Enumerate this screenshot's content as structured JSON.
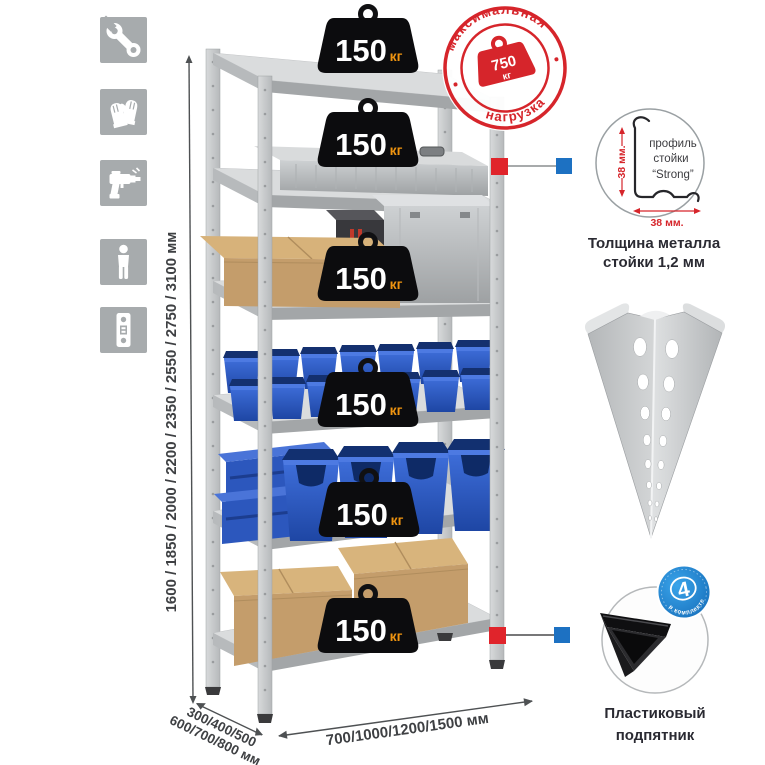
{
  "canvas": {
    "width": 765,
    "height": 765,
    "background": "#ffffff"
  },
  "sidebar_icons": [
    "wrench-icon",
    "gloves-icon",
    "drill-icon",
    "person-icon",
    "perforated-post-icon"
  ],
  "rack": {
    "shelf_count": 6,
    "shelf_load": {
      "value": "150",
      "unit": "кг"
    }
  },
  "stamp": {
    "arc_top": "максимальная",
    "arc_bottom": "нагрузка",
    "weight_value": "750",
    "weight_unit": "кг"
  },
  "dimensions": {
    "height": "1600 / 1850 / 2000 / 2200 / 2350 / 2550 / 2750 / 3100 мм",
    "depth_line1": "300/400/500",
    "depth_line2": "600/700/800 мм",
    "width": "700/1000/1200/1500 мм"
  },
  "profile_detail": {
    "label_line1": "профиль",
    "label_line2": "стойки",
    "label_line3": "“Strong”",
    "dim_vertical": "38 мм.",
    "dim_horizontal": "38 мм.",
    "caption_line1": "Толщина металла",
    "caption_line2": "стойки 1,2 мм"
  },
  "foot_detail": {
    "badge_value": "4",
    "badge_text": "в комплекте",
    "caption_line1": "Пластиковый",
    "caption_line2": "подпятник"
  },
  "colors": {
    "accent_red": "#d6252b",
    "marker_blue": "#1d71c2",
    "bin_blue": "#2f5ec9",
    "metal_gray": "#d6d8d9",
    "cardboard": "#c49d6b",
    "icon_gray": "#a7abad"
  }
}
